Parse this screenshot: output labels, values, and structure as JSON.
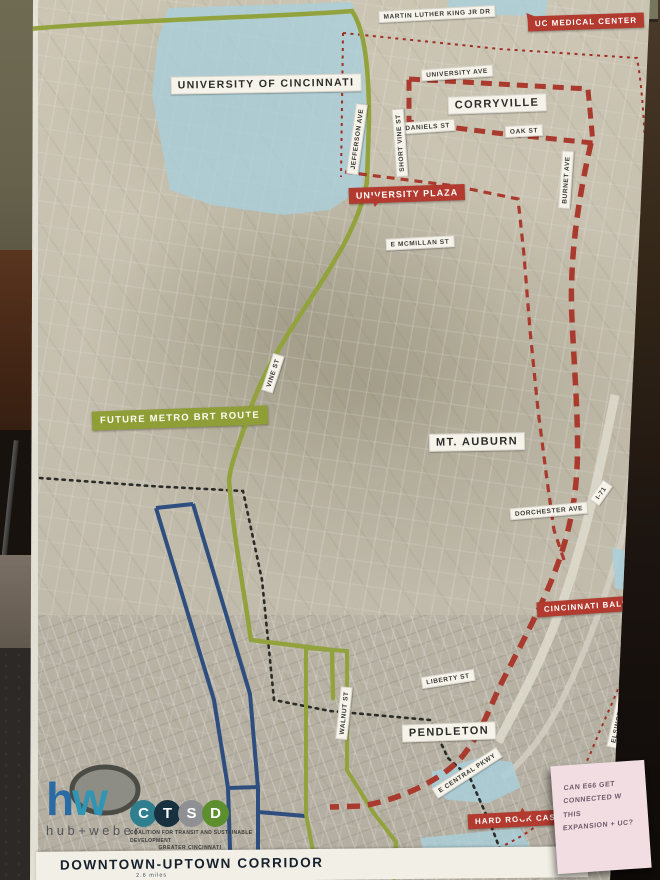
{
  "map": {
    "areas": {
      "university": "UNIVERSITY OF CINCINNATI",
      "corryville": "CORRYVILLE",
      "mt_auburn": "MT. AUBURN",
      "pendleton": "PENDLETON"
    },
    "streets": {
      "mlk": "MARTIN LUTHER KING JR DR",
      "university_ave": "UNIVERSITY AVE",
      "e_daniels": "E DANIELS ST",
      "oak": "OAK ST",
      "short_vine": "SHORT VINE ST",
      "jefferson": "JEFFERSON AVE",
      "burnet": "BURNET AVE",
      "e_mcmillan": "E MCMILLAN ST",
      "vine": "VINE ST",
      "dorchester": "DORCHESTER AVE",
      "i71": "I-71",
      "liberty": "LIBERTY ST",
      "walnut": "WALNUT ST",
      "e_central": "E CENTRAL PKWY",
      "elsinore": "ELSINORE AVE"
    },
    "pois": {
      "uc_medical": "UC MEDICAL CENTER",
      "university_plaza": "UNIVERSITY PLAZA",
      "ballet": "CINCINNATI BALLET",
      "casino": "HARD ROCK CASINO"
    },
    "route_callout": "FUTURE METRO BRT ROUTE",
    "colors": {
      "brt_green": "#92a23c",
      "route_red": "#a93a2d",
      "route_red_thin": "#9e2f24",
      "route_blue": "#2d4e7e",
      "boundary_black": "#2b2b28",
      "highlight_blue": "#a9cfdb",
      "label_red_bg": "#b23a2e"
    }
  },
  "footer": {
    "title": "DOWNTOWN-UPTOWN CORRIDOR",
    "subtitle": "2.6 miles",
    "hw": {
      "monogram_h": "h",
      "monogram_w": "w",
      "name": "hub+weber"
    },
    "ctsd": {
      "letters": [
        "C",
        "T",
        "S",
        "D"
      ],
      "tagline": "COALITION FOR TRANSIT AND SUSTAINABLE DEVELOPMENT",
      "tagline2": "GREATER CINCINNATI"
    }
  },
  "sticky_note": {
    "lines": [
      "CAN E66 GET",
      "CONNECTED W THIS",
      "EXPANSION + UC?"
    ]
  }
}
